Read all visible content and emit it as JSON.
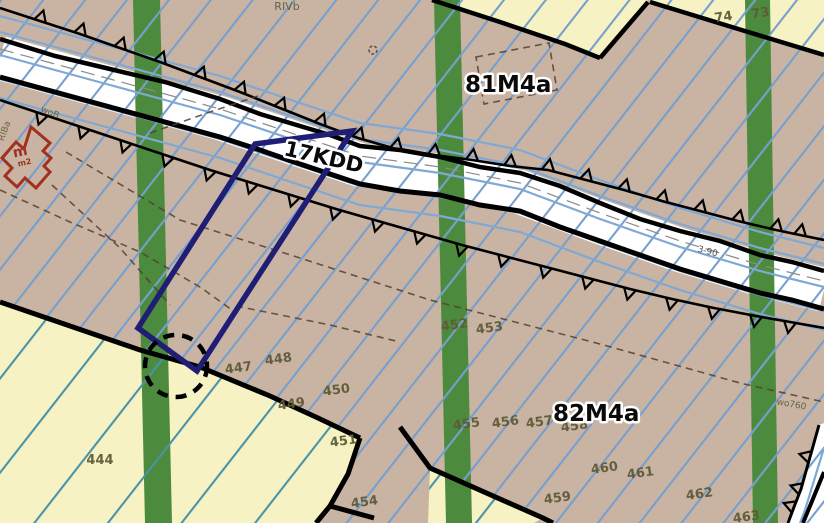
{
  "map": {
    "zone_labels": {
      "upper": "81M4a",
      "lower": "82M4a",
      "road": "17KDD"
    },
    "land_class": "RIVb",
    "parcels": {
      "p73": "73",
      "p74": "74",
      "p444": "444",
      "p447": "447",
      "p448": "448",
      "p449": "449",
      "p450": "450",
      "p451": "451",
      "p452": "452",
      "p453": "453",
      "p454": "454",
      "p455": "455",
      "p456": "456",
      "p457": "457",
      "p458": "458",
      "p459": "459",
      "p460": "460",
      "p461": "461",
      "p462": "462",
      "p463": "463"
    },
    "annotations": {
      "building": "m",
      "building_sub": "m2",
      "soil_left": "RIBa",
      "ditch_top": "woB",
      "ditch_right": "wo760",
      "road_dim": "3-90"
    },
    "colors": {
      "parcel_fill": "#c9b3a2",
      "reserve_fill": "#f6f2c4",
      "green_belt": "#4c8b3d",
      "hatch_primary": "#769fce",
      "hatch_secondary": "#4a93a6",
      "selection_outline": "#201d75",
      "building_outline": "#a2301f",
      "number_color": "#5e5b39"
    }
  }
}
